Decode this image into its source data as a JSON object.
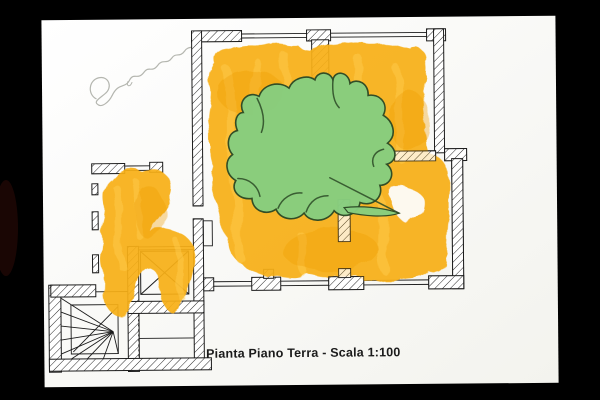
{
  "photo": {
    "background_color": "#000000",
    "paper_color": "#fdfdfa"
  },
  "colors": {
    "bg": "#000000",
    "paper": "#fdfdfa",
    "ink": "#1c1c1c",
    "paint-primary": "#F8AF14",
    "paint-light": "#FFCC4D",
    "paint-deep": "#EE9C04",
    "cutout-green": "#87CE7F",
    "cutout-outline": "#2c4a26",
    "pencil": "#a8aaa2",
    "caption": "#1b1b1b"
  },
  "plan": {
    "caption": "Pianta Piano Terra - Scala 1:100"
  },
  "handwriting": {
    "signature": "Simone"
  }
}
